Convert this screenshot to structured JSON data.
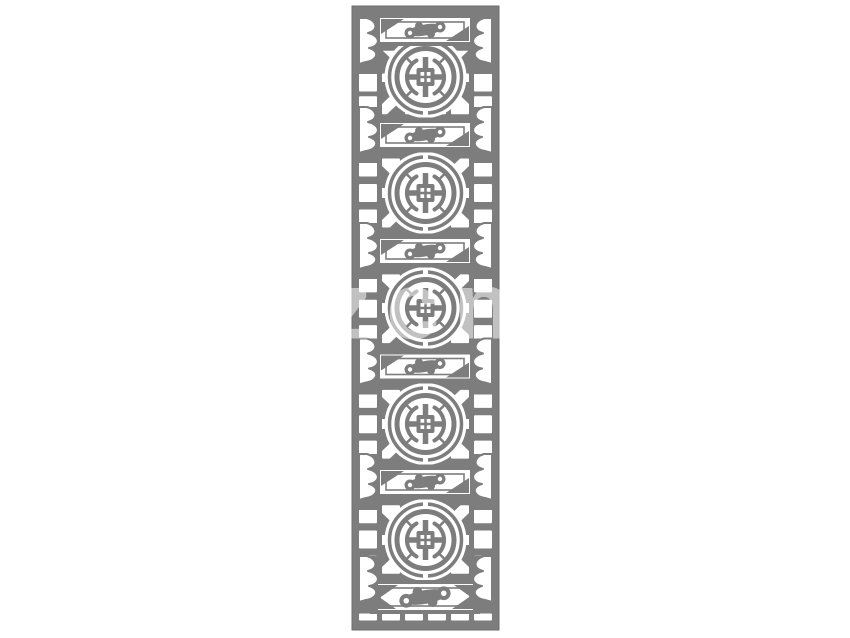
{
  "artwork": {
    "title": "chinese-lattice-panel",
    "description": "Tall gray Chinese lattice screen panel on a white background: five circular coin medallions alternating with ruyi-cloud bar cartouches, square grid openings, radiating triangle fills and scalloped cloud brackets along both edges.",
    "pattern_color": "#7d7d7d",
    "outline_color": "#6e6e6e",
    "background_color": "#ffffff",
    "medallion_count": 5,
    "cloud_bar_count": 6,
    "edge_bracket_rows": 6
  },
  "watermark": {
    "label": "zcn",
    "color": "rgba(255,255,255,0.52)"
  }
}
